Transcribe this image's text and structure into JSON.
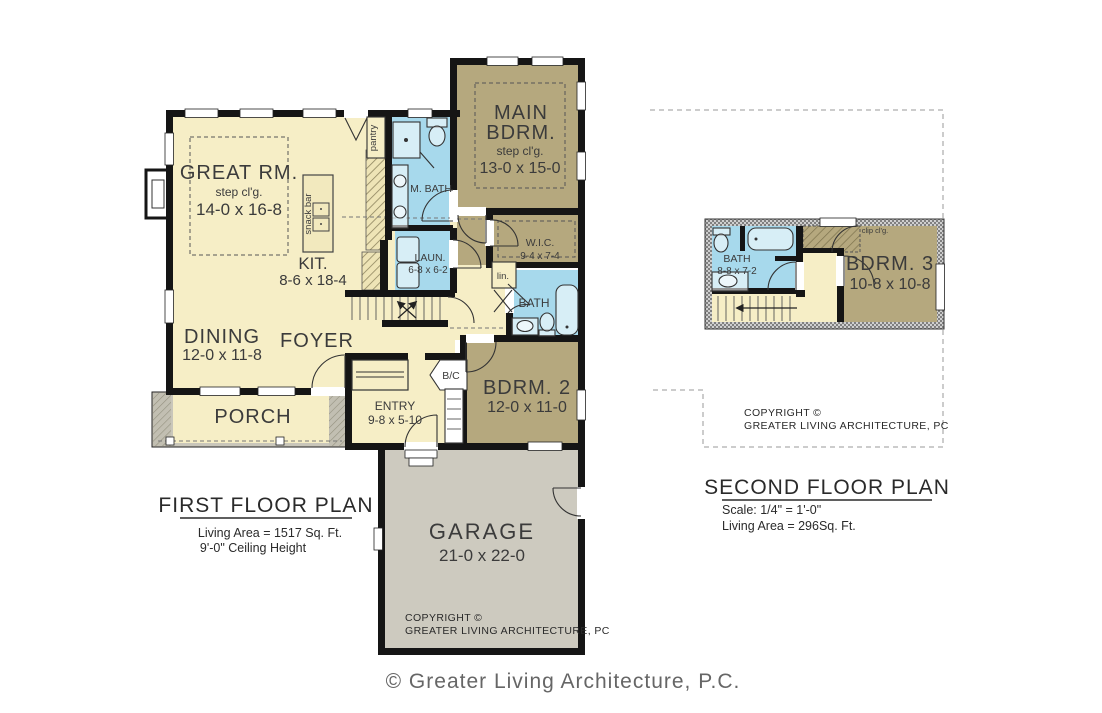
{
  "first_floor": {
    "title": "FIRST FLOOR PLAN",
    "living_area": "Living Area =  1517 Sq. Ft.",
    "ceiling_height": "9'-0\" Ceiling Height",
    "rooms": {
      "great_room": {
        "name": "GREAT RM.",
        "ceiling": "step cl'g.",
        "size": "14-0 x 16-8"
      },
      "kitchen": {
        "name": "KIT.",
        "size": "8-6 x 18-4"
      },
      "snack_bar": "snack bar",
      "pantry": "pantry",
      "dining": {
        "name": "DINING",
        "size": "12-0 x 11-8"
      },
      "foyer": {
        "name": "FOYER"
      },
      "porch": {
        "name": "PORCH"
      },
      "entry": {
        "name": "ENTRY",
        "size": "9-8 x 5-10"
      },
      "broom_closet": "B/C",
      "garage": {
        "name": "GARAGE",
        "size": "21-0 x 22-0"
      },
      "main_bedroom": {
        "name_line1": "MAIN",
        "name_line2": "BDRM.",
        "ceiling": "step cl'g.",
        "size": "13-0 x 15-0"
      },
      "master_bath": {
        "name": "M. BATH"
      },
      "laundry": {
        "name": "LAUN.",
        "size": "6-8 x 6-2"
      },
      "walk_in_closet": {
        "name": "W.I.C.",
        "size": "9-4 x 7-4"
      },
      "linen": "lin.",
      "bath": {
        "name": "BATH"
      },
      "bedroom2": {
        "name": "BDRM. 2",
        "size": "12-0 x 11-0"
      }
    },
    "copyright_line1": "COPYRIGHT ©",
    "copyright_line2": "GREATER LIVING ARCHITECTURE, PC"
  },
  "second_floor": {
    "title": "SECOND FLOOR PLAN",
    "scale": "Scale: 1/4\" = 1'-0\"",
    "living_area": "Living Area =  296Sq. Ft.",
    "rooms": {
      "bath": {
        "name": "BATH",
        "size": "8-8 x 7-2"
      },
      "bedroom3": {
        "name": "BDRM. 3",
        "size": "10-8 x 10-8"
      },
      "clip_ceiling": "clip cl'g."
    },
    "copyright_line1": "COPYRIGHT ©",
    "copyright_line2": "GREATER LIVING ARCHITECTURE, PC"
  },
  "footer": "© Greater Living Architecture, P.C.",
  "colors": {
    "room_cream": "#f6eec6",
    "room_tan": "#b5a87e",
    "room_blue": "#a7d9ec",
    "porch_gray": "#c9c6ba",
    "garage_gray": "#cdcabf",
    "wall_black": "#151515"
  }
}
